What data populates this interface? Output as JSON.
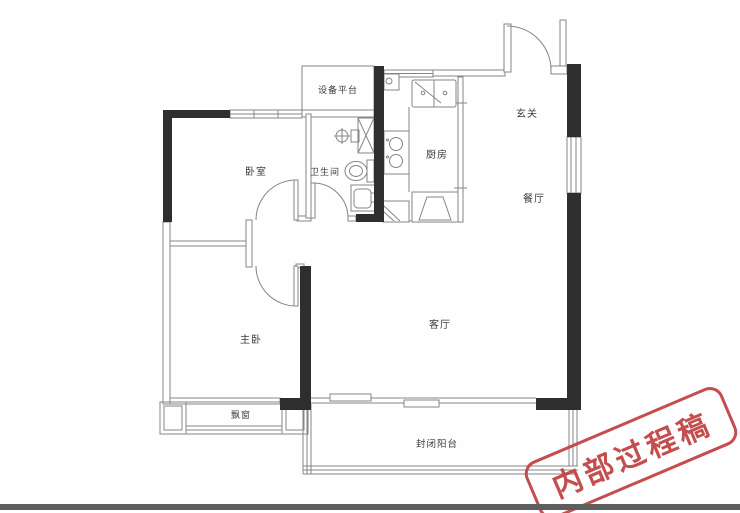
{
  "floorplan": {
    "rooms": [
      {
        "id": "equipment-platform",
        "label": "设备平台"
      },
      {
        "id": "bedroom",
        "label": "卧室"
      },
      {
        "id": "bathroom",
        "label": "卫生间"
      },
      {
        "id": "kitchen",
        "label": "厨房"
      },
      {
        "id": "entry-hall",
        "label": "玄关"
      },
      {
        "id": "dining-room",
        "label": "餐厅"
      },
      {
        "id": "living-room",
        "label": "客厅"
      },
      {
        "id": "master-bedroom",
        "label": "主卧"
      },
      {
        "id": "bay-window",
        "label": "飘窗"
      },
      {
        "id": "enclosed-balcony",
        "label": "封闭阳台"
      }
    ],
    "colors": {
      "structural_wall": "#2e2e2e",
      "partition_line": "#858585",
      "label_text": "#3c3c3c",
      "background": "#fefefe",
      "bottom_bar": "#5e5e5e"
    }
  },
  "stamp": {
    "text": "内部过程稿",
    "color": "#c0403f"
  }
}
